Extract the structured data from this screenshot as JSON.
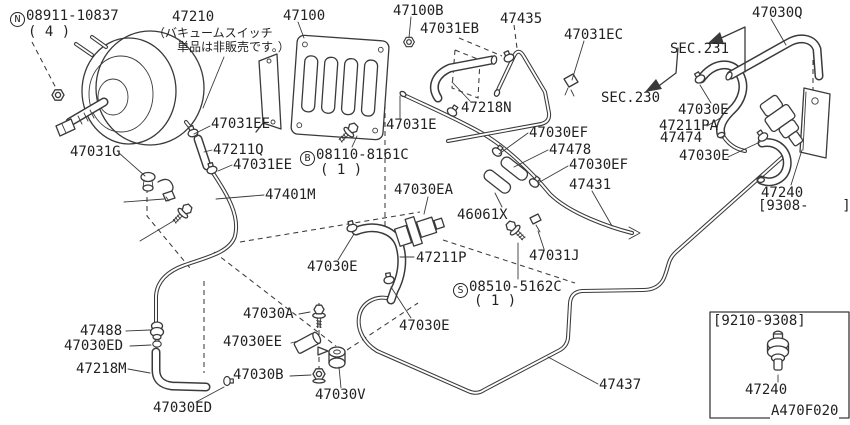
{
  "colors": {
    "background": "#ffffff",
    "line": "#3a3a3a",
    "text": "#222222"
  },
  "labels": [
    {
      "name": "fastener-N-partno",
      "text": "Ⓝ08911-10837",
      "x": 10,
      "y": 9
    },
    {
      "name": "fastener-N-qty",
      "text": "( 4 )",
      "x": 28,
      "y": 25
    },
    {
      "name": "part-47210",
      "text": "47210",
      "x": 172,
      "y": 10
    },
    {
      "name": "note-jp-line1",
      "text": "（バキュームスイッチ",
      "x": 153,
      "y": 27,
      "cls": "jp"
    },
    {
      "name": "note-jp-line2",
      "text": "単品は非販売です。）",
      "x": 177,
      "y": 41,
      "cls": "jp"
    },
    {
      "name": "part-47100",
      "text": "47100",
      "x": 283,
      "y": 9
    },
    {
      "name": "part-47100B",
      "text": "47100B",
      "x": 393,
      "y": 4
    },
    {
      "name": "part-47031EB",
      "text": "47031EB",
      "x": 420,
      "y": 22
    },
    {
      "name": "part-47435",
      "text": "47435",
      "x": 500,
      "y": 12
    },
    {
      "name": "part-47031EC",
      "text": "47031EC",
      "x": 564,
      "y": 28
    },
    {
      "name": "part-47030Q",
      "text": "47030Q",
      "x": 752,
      "y": 6
    },
    {
      "name": "section-ref-231",
      "text": "SEC.231",
      "x": 670,
      "y": 42
    },
    {
      "name": "section-ref-230",
      "text": "SEC.230",
      "x": 601,
      "y": 91
    },
    {
      "name": "part-47030E-1",
      "text": "47030E",
      "x": 678,
      "y": 103
    },
    {
      "name": "part-47211PA",
      "text": "47211PA",
      "x": 659,
      "y": 119
    },
    {
      "name": "part-47474",
      "text": "47474",
      "x": 660,
      "y": 131
    },
    {
      "name": "part-47030E-2",
      "text": "47030E",
      "x": 679,
      "y": 149
    },
    {
      "name": "part-47218N",
      "text": "47218N",
      "x": 461,
      "y": 101
    },
    {
      "name": "part-47031E",
      "text": "47031E",
      "x": 386,
      "y": 118
    },
    {
      "name": "part-47031EE-1",
      "text": "47031EE",
      "x": 211,
      "y": 117
    },
    {
      "name": "part-47211Q",
      "text": "47211Q",
      "x": 213,
      "y": 143
    },
    {
      "name": "part-47031EE-2",
      "text": "47031EE",
      "x": 233,
      "y": 158
    },
    {
      "name": "part-47031G",
      "text": "47031G",
      "x": 70,
      "y": 145
    },
    {
      "name": "fastener-B-partno",
      "text": "Ⓑ08110-8161C",
      "x": 300,
      "y": 148
    },
    {
      "name": "fastener-B-qty",
      "text": "( 1 )",
      "x": 320,
      "y": 163
    },
    {
      "name": "part-47401M",
      "text": "47401M",
      "x": 265,
      "y": 188
    },
    {
      "name": "part-47030EA",
      "text": "47030EA",
      "x": 394,
      "y": 183
    },
    {
      "name": "part-46061X",
      "text": "46061X",
      "x": 457,
      "y": 208
    },
    {
      "name": "part-47030EF-1",
      "text": "47030EF",
      "x": 529,
      "y": 126
    },
    {
      "name": "part-47478",
      "text": "47478",
      "x": 549,
      "y": 143
    },
    {
      "name": "part-47030EF-2",
      "text": "47030EF",
      "x": 569,
      "y": 158
    },
    {
      "name": "part-47431",
      "text": "47431",
      "x": 569,
      "y": 178
    },
    {
      "name": "part-47031J",
      "text": "47031J",
      "x": 529,
      "y": 249
    },
    {
      "name": "fastener-S-partno",
      "text": "Ⓢ08510-5162C",
      "x": 453,
      "y": 280
    },
    {
      "name": "fastener-S-qty",
      "text": "( 1 )",
      "x": 474,
      "y": 294
    },
    {
      "name": "part-47030E-3",
      "text": "47030E",
      "x": 307,
      "y": 260
    },
    {
      "name": "part-47211P",
      "text": "47211P",
      "x": 416,
      "y": 251
    },
    {
      "name": "part-47030E-4",
      "text": "47030E",
      "x": 399,
      "y": 319
    },
    {
      "name": "part-47030A",
      "text": "47030A",
      "x": 243,
      "y": 307
    },
    {
      "name": "part-47030EE",
      "text": "47030EE",
      "x": 223,
      "y": 335
    },
    {
      "name": "part-47030B",
      "text": "47030B",
      "x": 233,
      "y": 368
    },
    {
      "name": "part-47030V",
      "text": "47030V",
      "x": 315,
      "y": 388
    },
    {
      "name": "part-47488",
      "text": "47488",
      "x": 80,
      "y": 324
    },
    {
      "name": "part-47030ED-1",
      "text": "47030ED",
      "x": 64,
      "y": 339
    },
    {
      "name": "part-47218M",
      "text": "47218M",
      "x": 76,
      "y": 362
    },
    {
      "name": "part-47030ED-2",
      "text": "47030ED",
      "x": 153,
      "y": 401
    },
    {
      "name": "part-47437",
      "text": "47437",
      "x": 599,
      "y": 378
    },
    {
      "name": "part-47240",
      "text": "47240",
      "x": 761,
      "y": 186
    },
    {
      "name": "part-47240-date-range",
      "text": "[9308-    ]",
      "x": 758,
      "y": 199
    },
    {
      "name": "inset-date-range",
      "text": "[9210-9308]",
      "x": 713,
      "y": 314
    },
    {
      "name": "inset-part-47240",
      "text": "47240",
      "x": 745,
      "y": 383
    },
    {
      "name": "diagram-code",
      "text": "A470F020",
      "x": 770,
      "y": 404,
      "cls": "bgw"
    }
  ]
}
